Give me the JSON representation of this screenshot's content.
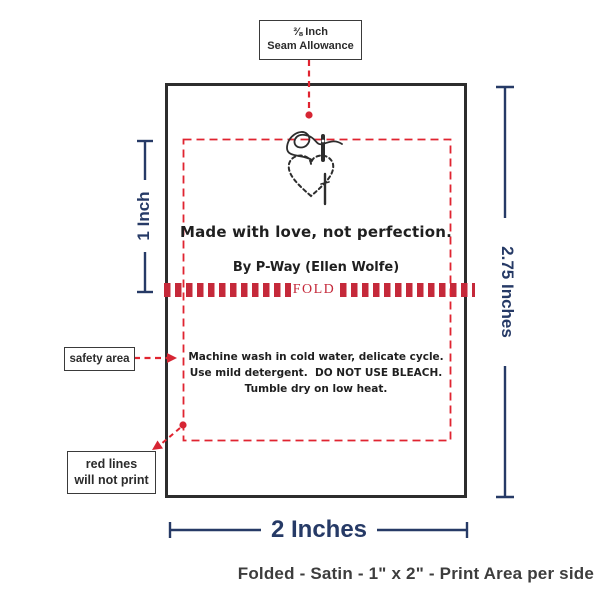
{
  "annotations": {
    "seam_allowance": {
      "line1": "⅜ Inch",
      "line2": "Seam Allowance"
    },
    "safety_area": "safety area",
    "red_lines": {
      "line1": "red lines",
      "line2": "will not print"
    }
  },
  "label": {
    "message": "Made with love, not perfection.",
    "byline": "By P-Way (Ellen Wolfe)",
    "fold": "FOLD",
    "care_lines": [
      "Machine wash in cold water, delicate cycle.",
      "Use mild detergent.  DO NOT USE BLEACH.",
      "Tumble dry on low heat."
    ]
  },
  "dimensions": {
    "fold_area_height": "1 Inch",
    "label_height": "2.75 Inches",
    "label_width": "2 Inches"
  },
  "footer": {
    "caption": "Folded - Satin - 1\" x 2\" - Print Area per side"
  },
  "colors": {
    "dimension_navy": "#263a66",
    "annotation_red": "#e02430",
    "fold_band_red": "#c5293a",
    "ink": "#2b2b2b"
  }
}
